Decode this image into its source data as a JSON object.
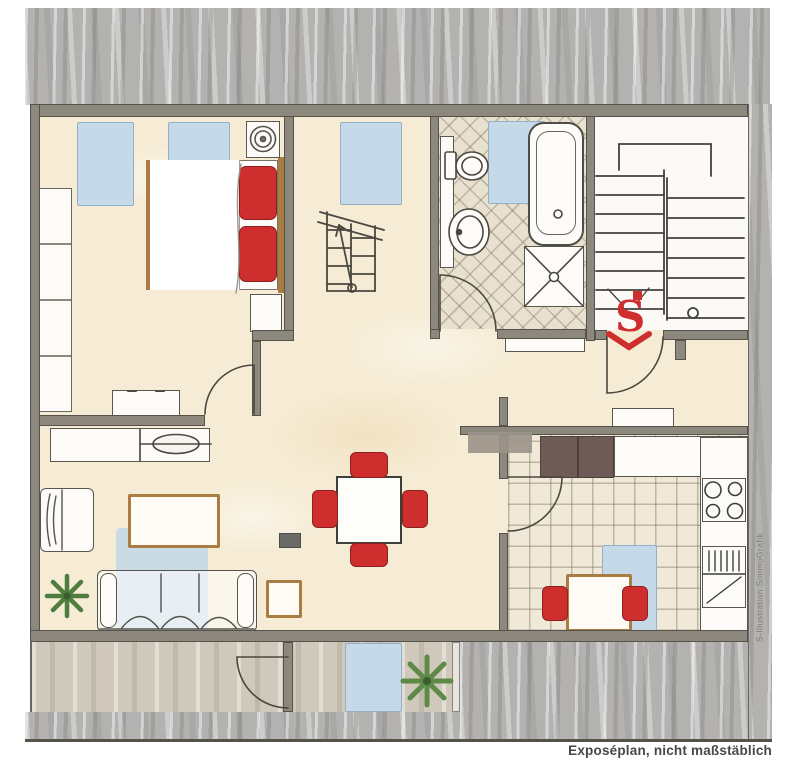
{
  "document": {
    "type": "floor-plan-sketch",
    "footer_caption": "Exposéplan, nicht maßstäblich",
    "credit_vertical": "S-Illustration:SimmoGrafik",
    "stairwell_logo_letter": "S"
  },
  "colors": {
    "floor": "#f6ecd5",
    "roof": "#b3b2b0",
    "roof_light": "#cfc8bb",
    "wall": "#8d887e",
    "wall_edge": "#55524a",
    "window_blue": "#c6d9e8",
    "accent_red": "#cf2e2e",
    "accent_red_dark": "#8e1f1f",
    "tan": "#a97c42",
    "cabinet_dark": "#6f5b55",
    "bath_tile": "#e9e1cf",
    "kitchen_tile": "#f0e9d8",
    "stair_bg": "#fbfaf6",
    "ink": "#4a4840",
    "plant": "#4e7d3e",
    "text": "#474747"
  }
}
